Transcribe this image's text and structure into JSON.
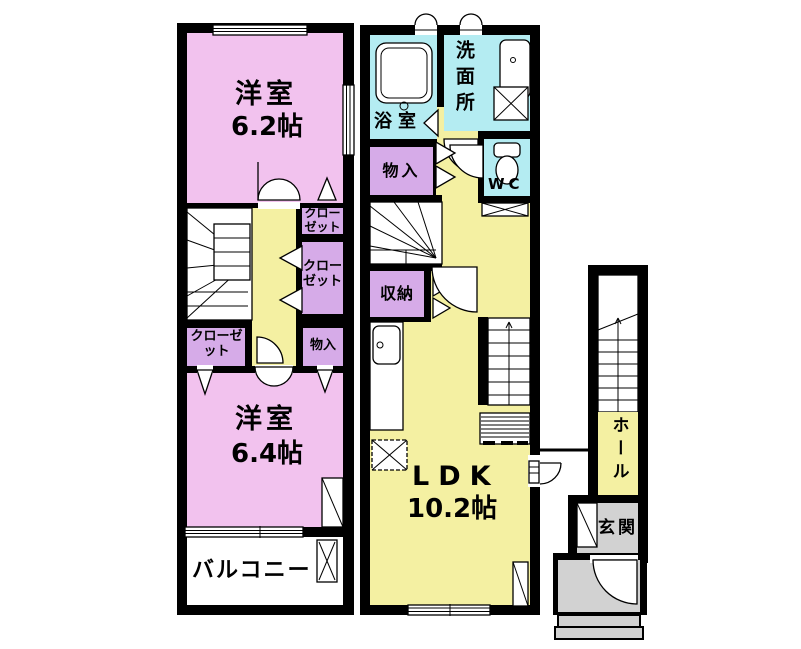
{
  "colors": {
    "pink": "#f2c2ee",
    "purple": "#d6abe8",
    "yellow": "#f4f0a2",
    "cyan": "#b4ecf2",
    "gray": "#d2d2d2",
    "wall": "#000000"
  },
  "floor2": {
    "room_a_name": "洋室",
    "room_a_size": "6.2帖",
    "room_b_name": "洋室",
    "room_b_size": "6.4帖",
    "closet_top": "クローゼット",
    "closet_mid": "クローゼット",
    "closet_left": "クローゼット",
    "storage": "物入",
    "balcony": "バルコニー"
  },
  "floor1": {
    "bathroom": "浴室",
    "washroom": "洗面所",
    "toilet": "WC",
    "storage_upper": "物入",
    "storage_lower": "収納",
    "ldk_name": "LDK",
    "ldk_size": "10.2帖"
  },
  "entrance": {
    "hall": "ホール",
    "foyer": "玄関"
  }
}
